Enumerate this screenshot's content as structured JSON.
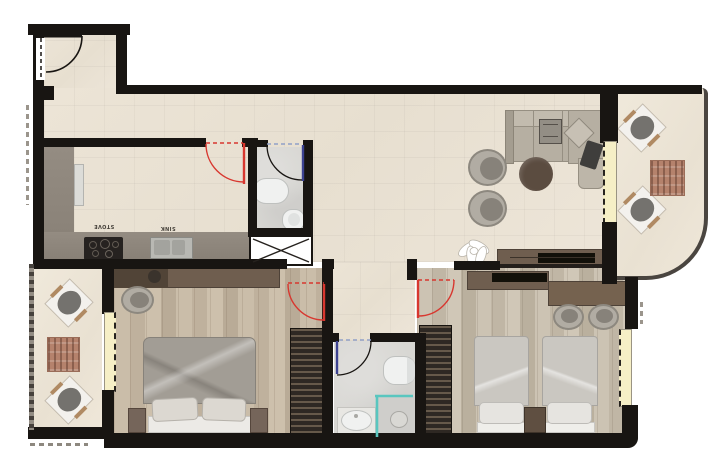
{
  "labels": {
    "stove": "STOVE",
    "sink": "SINK"
  },
  "palette": {
    "wall": "#181512",
    "door_swing_red": "#d8372f",
    "door_leaf_blue": "#3c4291",
    "shower_glass_teal": "#59c6bf",
    "window_yellow": "#f6efc6",
    "tile_floor": "#eae2d4",
    "balcony_floor": "#ede6d8",
    "wood_floor": "#c6b9a6",
    "bath_floor": "#d8d7d3",
    "kitchen_counter": "#8d857b",
    "furniture_brown": "#6f5e4f",
    "wardrobe_dark": "#332d27",
    "sofa_beige": "#b6afa2",
    "lounge_mat_terracotta": "#b5826c"
  }
}
